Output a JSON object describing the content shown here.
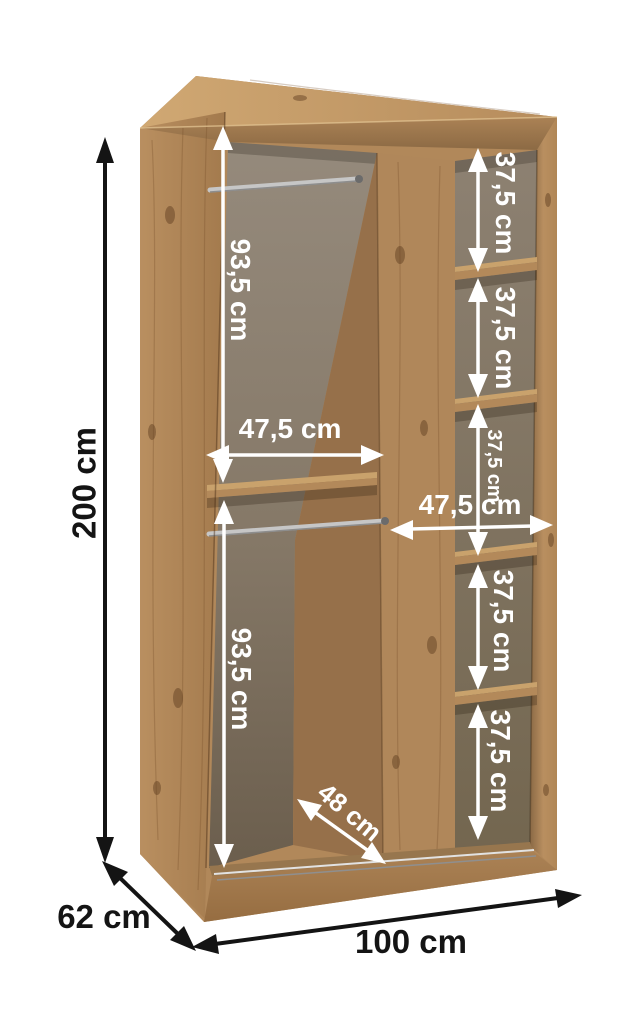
{
  "diagram": {
    "type": "furniture-dimension-diagram",
    "subject": "two-door sliding wardrobe, open carcass with shelves and hanging rails"
  },
  "dimensions": {
    "height": "200 cm",
    "depth": "62 cm",
    "width": "100 cm",
    "left_upper_hanging": "93,5 cm",
    "left_lower_hanging": "93,5 cm",
    "left_inner_width": "47,5 cm",
    "right_inner_width": "47,5 cm",
    "right_gap_1": "37,5 cm",
    "right_gap_2": "37,5 cm",
    "right_gap_3": "37,5 cm",
    "right_gap_4": "37,5 cm",
    "right_gap_5": "37,5 cm",
    "door_width": "48 cm"
  },
  "colors": {
    "background": "#ffffff",
    "wood_mid": "#b1885a",
    "wood_plinth": "#a67d50",
    "divider_front": "#b0875a",
    "divider_side": "#96704a",
    "shelf_top": "#c9a26c",
    "shelf_edge": "#b3895a",
    "rail_silver": "#c6c6c6",
    "track_light": "#e2e2e2",
    "track_dark": "#8f8f8f",
    "arrow_white": "#ffffff",
    "arrow_black": "#141414"
  }
}
